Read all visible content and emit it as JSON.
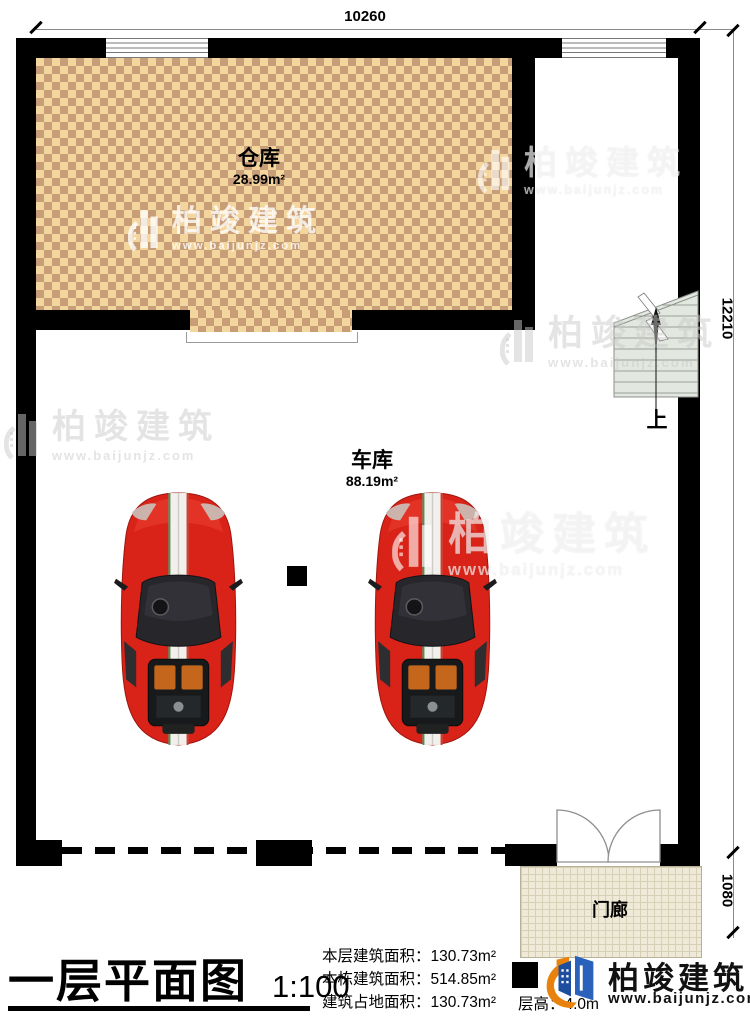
{
  "dimensions": {
    "top": "10260",
    "right_total": "12210",
    "porch": "1080"
  },
  "rooms": {
    "warehouse": {
      "name": "仓库",
      "area": "28.99m²"
    },
    "garage": {
      "name": "车库",
      "area": "88.19m²"
    },
    "porch": {
      "name": "门廊"
    }
  },
  "stairs": {
    "direction_label": "上"
  },
  "legend": {
    "title": "一层平面图",
    "scale": "1:100",
    "stats": [
      {
        "text": "本层建筑面积：130.73m²"
      },
      {
        "text": "本栋建筑面积：514.85m²"
      },
      {
        "text": "建筑占地面积：130.73m²"
      },
      {
        "text": "层高：4.0m"
      }
    ]
  },
  "brand": {
    "name": "柏竣建筑",
    "url": "www.baijunjz.com"
  },
  "watermark": {
    "name": "柏竣建筑",
    "url": "www.baijunjz.com"
  },
  "colors": {
    "wall": "#000000",
    "checker_light": "#f3d59e",
    "checker_dark": "#c89e79",
    "porch_tile": "#efe9d8",
    "car_red": "#d92318",
    "stair_fill": "#e2e7df",
    "brand_blue": "#1d4f9e",
    "brand_orange": "#e8820c"
  }
}
